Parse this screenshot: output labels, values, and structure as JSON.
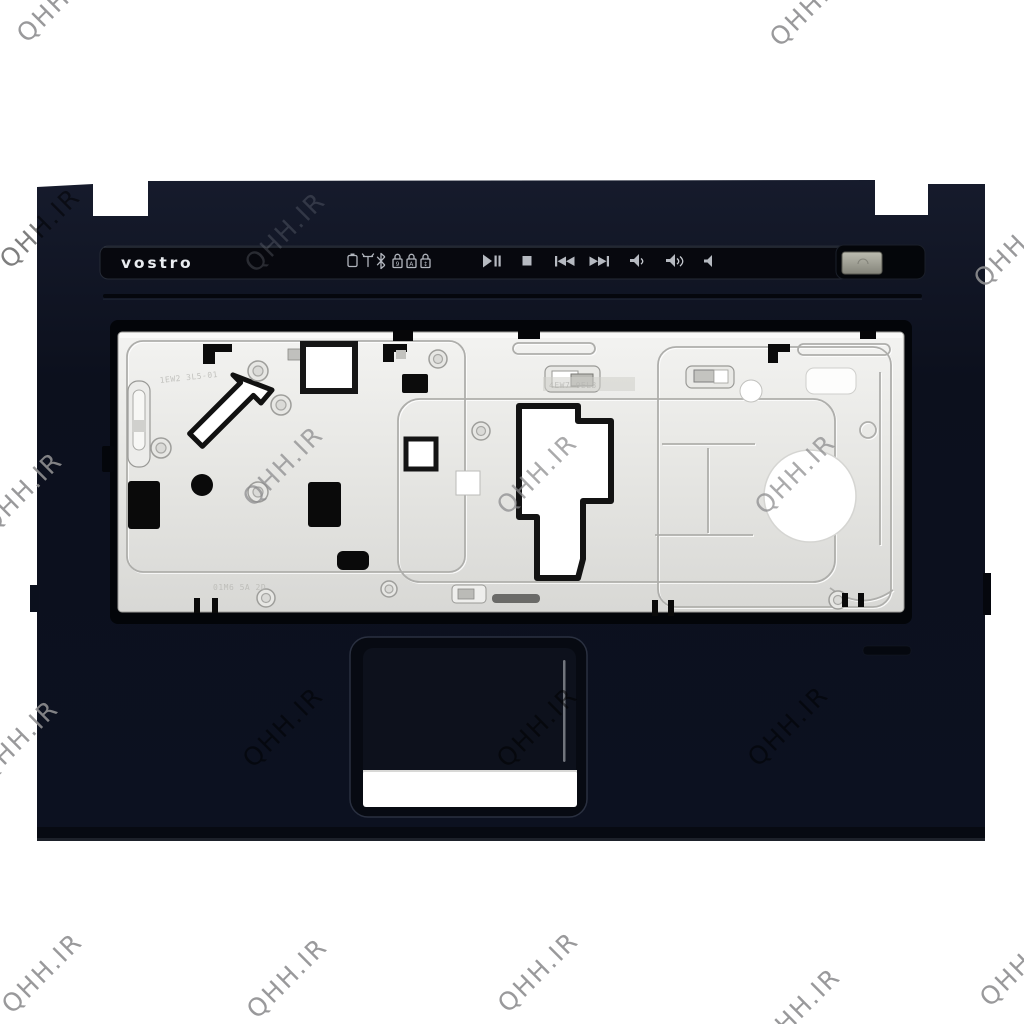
{
  "page": {
    "background": "#ffffff"
  },
  "watermark": {
    "text": "QHH.IR",
    "color": "#8f8f91"
  },
  "device": {
    "type": "laptop-palmrest-top-cover",
    "brand": "vostro",
    "colors": {
      "chassis": "#0d1220",
      "brand_strip": "#07080e",
      "metal_plate": "#e9e9e6",
      "power_button": "#9a9a90",
      "touchpad_cutout": "#ffffff"
    },
    "status_icons": [
      "battery-icon",
      "wifi-icon",
      "bluetooth-icon",
      "num-lock-icon",
      "caps-lock-icon",
      "scroll-lock-icon"
    ],
    "media_icons": [
      "play-pause-icon",
      "stop-icon",
      "previous-track-icon",
      "next-track-icon",
      "volume-down-icon",
      "volume-up-icon",
      "mute-icon"
    ],
    "lock_glyphs": {
      "num": "9",
      "caps": "A",
      "scroll": "↕"
    },
    "engravings": {
      "plate_left_top": "1EW2 3L5-01",
      "plate_left_bottom": "01M6 5A 2D",
      "plate_center": "4EW7 0EL3"
    }
  }
}
